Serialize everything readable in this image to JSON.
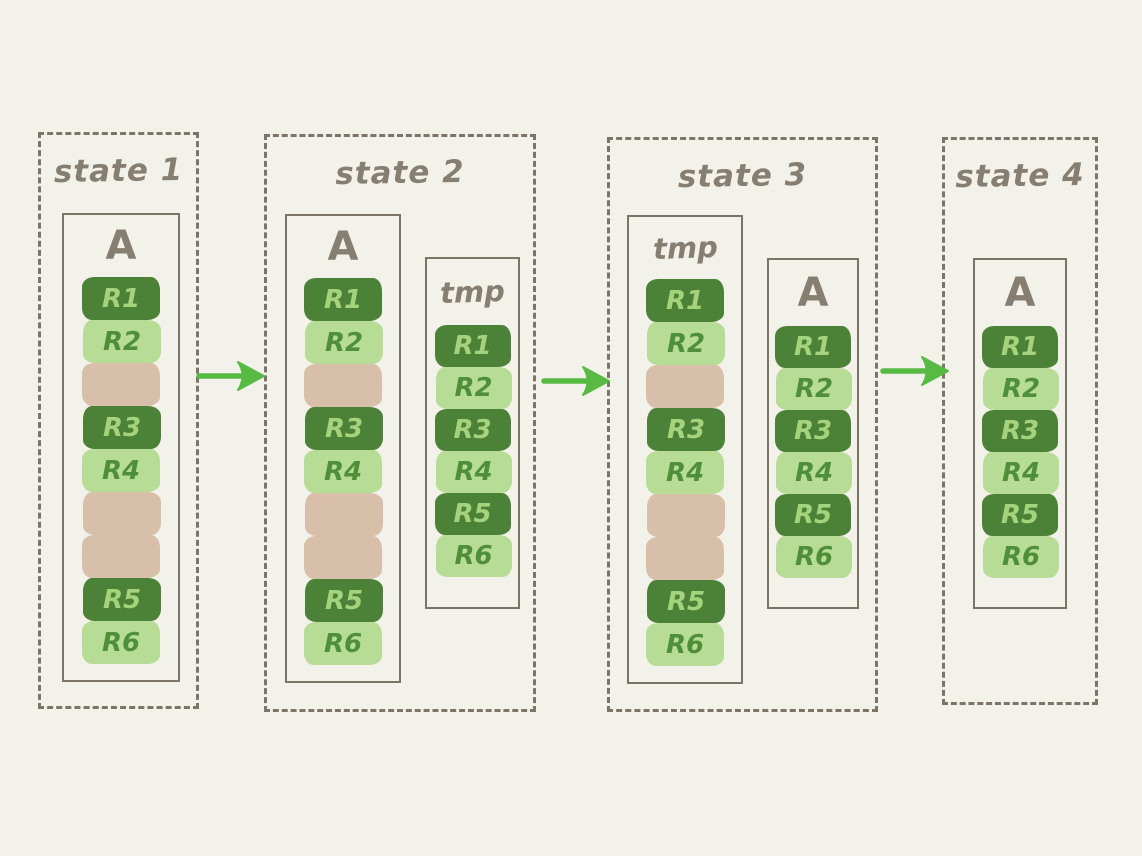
{
  "canvas": {
    "background": "#f2f1ea"
  },
  "palette": {
    "dark_green": "#4c8138",
    "light_green": "#b7dc96",
    "tan": "#d8bfa9",
    "dark_block_text": "#a4d37c",
    "light_block_text": "#4f8f3a",
    "frame_gray": "#7c7467",
    "title_gray": "#867e70",
    "arrow_green": "#57bb43"
  },
  "states": [
    {
      "title": "state 1",
      "columns": [
        {
          "label": "A",
          "variant": "fragmented",
          "blocks": [
            {
              "label": "R1",
              "type": "dark"
            },
            {
              "label": "R2",
              "type": "light"
            },
            {
              "label": "",
              "type": "empty"
            },
            {
              "label": "R3",
              "type": "dark"
            },
            {
              "label": "R4",
              "type": "light"
            },
            {
              "label": "",
              "type": "empty"
            },
            {
              "label": "",
              "type": "empty"
            },
            {
              "label": "R5",
              "type": "dark"
            },
            {
              "label": "R6",
              "type": "light"
            }
          ]
        }
      ]
    },
    {
      "title": "state 2",
      "columns": [
        {
          "label": "A",
          "variant": "fragmented",
          "blocks": [
            {
              "label": "R1",
              "type": "dark"
            },
            {
              "label": "R2",
              "type": "light"
            },
            {
              "label": "",
              "type": "empty"
            },
            {
              "label": "R3",
              "type": "dark"
            },
            {
              "label": "R4",
              "type": "light"
            },
            {
              "label": "",
              "type": "empty"
            },
            {
              "label": "",
              "type": "empty"
            },
            {
              "label": "R5",
              "type": "dark"
            },
            {
              "label": "R6",
              "type": "light"
            }
          ]
        },
        {
          "label": "tmp",
          "variant": "compact",
          "blocks": [
            {
              "label": "R1",
              "type": "dark"
            },
            {
              "label": "R2",
              "type": "light"
            },
            {
              "label": "R3",
              "type": "dark"
            },
            {
              "label": "R4",
              "type": "light"
            },
            {
              "label": "R5",
              "type": "dark"
            },
            {
              "label": "R6",
              "type": "light"
            }
          ]
        }
      ]
    },
    {
      "title": "state 3",
      "columns": [
        {
          "label": "tmp",
          "variant": "fragmented",
          "blocks": [
            {
              "label": "R1",
              "type": "dark"
            },
            {
              "label": "R2",
              "type": "light"
            },
            {
              "label": "",
              "type": "empty"
            },
            {
              "label": "R3",
              "type": "dark"
            },
            {
              "label": "R4",
              "type": "light"
            },
            {
              "label": "",
              "type": "empty"
            },
            {
              "label": "",
              "type": "empty"
            },
            {
              "label": "R5",
              "type": "dark"
            },
            {
              "label": "R6",
              "type": "light"
            }
          ]
        },
        {
          "label": "A",
          "variant": "compact",
          "blocks": [
            {
              "label": "R1",
              "type": "dark"
            },
            {
              "label": "R2",
              "type": "light"
            },
            {
              "label": "R3",
              "type": "dark"
            },
            {
              "label": "R4",
              "type": "light"
            },
            {
              "label": "R5",
              "type": "dark"
            },
            {
              "label": "R6",
              "type": "light"
            }
          ]
        }
      ]
    },
    {
      "title": "state 4",
      "columns": [
        {
          "label": "A",
          "variant": "compact",
          "blocks": [
            {
              "label": "R1",
              "type": "dark"
            },
            {
              "label": "R2",
              "type": "light"
            },
            {
              "label": "R3",
              "type": "dark"
            },
            {
              "label": "R4",
              "type": "light"
            },
            {
              "label": "R5",
              "type": "dark"
            },
            {
              "label": "R6",
              "type": "light"
            }
          ]
        }
      ]
    }
  ],
  "arrows": [
    {
      "name": "flow-arrow-1",
      "direction": "right"
    },
    {
      "name": "flow-arrow-2",
      "direction": "right"
    },
    {
      "name": "flow-arrow-3",
      "direction": "right"
    }
  ]
}
